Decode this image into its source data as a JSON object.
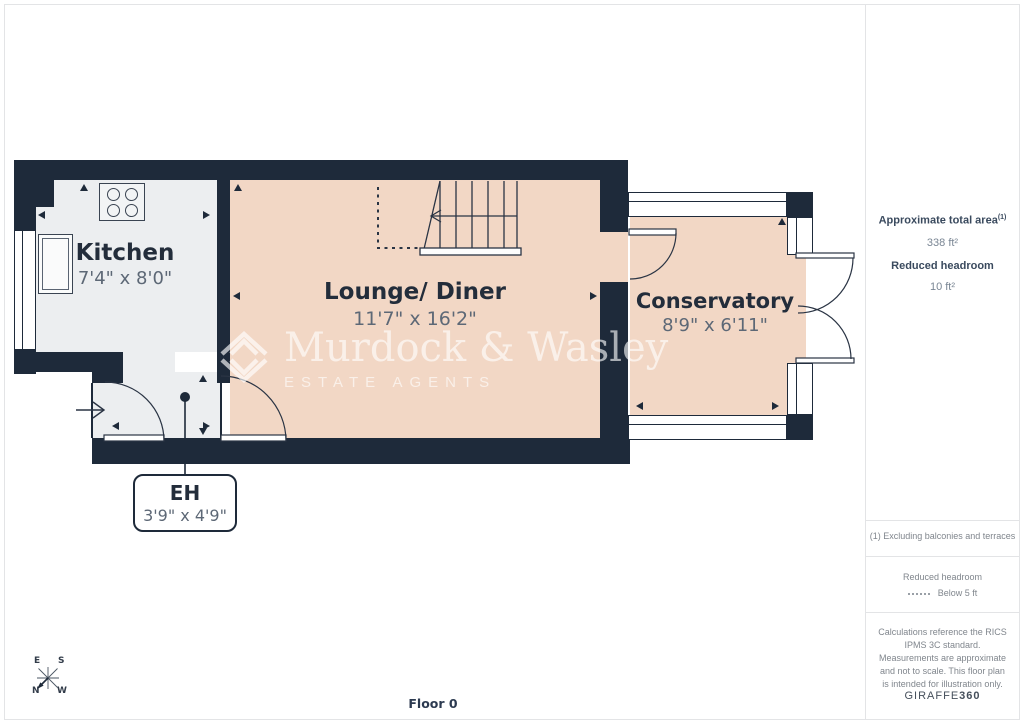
{
  "plan": {
    "floor_label": "Floor 0",
    "rooms": {
      "kitchen": {
        "name": "Kitchen",
        "dims": "7'4\" x 8'0\""
      },
      "lounge": {
        "name": "Lounge/ Diner",
        "dims": "11'7\" x 16'2\""
      },
      "conservatory": {
        "name": "Conservatory",
        "dims": "8'9\" x 6'11\""
      },
      "eh": {
        "name": "EH",
        "dims": "3'9\" x 4'9\""
      }
    },
    "compass": {
      "top_left": "E",
      "top_right": "S",
      "bottom_left": "N",
      "bottom_right": "W"
    }
  },
  "watermark": {
    "brand": "Murdock & Wasley",
    "tagline": "ESTATE AGENTS"
  },
  "sidebar": {
    "total_area": {
      "label": "Approximate total area",
      "sup": "(1)",
      "value": "338 ft²"
    },
    "reduced_headroom": {
      "label": "Reduced headroom",
      "value": "10 ft²"
    },
    "footnote": "(1) Excluding balconies and terraces",
    "legend": {
      "label": "Reduced headroom",
      "value": "Below 5 ft"
    },
    "disclaimer": "Calculations reference the RICS IPMS 3C standard. Measurements are approximate and not to scale. This floor plan is intended for illustration only.",
    "brand": {
      "name": "GIRAFFE",
      "suffix": "360"
    }
  },
  "colors": {
    "wall": "#1e2a3a",
    "floor_warm": "#f2d7c5",
    "floor_cool": "#eceef0",
    "name_text": "#232d3b",
    "dim_text": "#5d6876",
    "frame_line": "#e3e4e6",
    "sb_label": "#3a4a5e",
    "sb_value": "#7a8694",
    "sb_muted": "#80868d",
    "brand_text": "#454f5b"
  }
}
